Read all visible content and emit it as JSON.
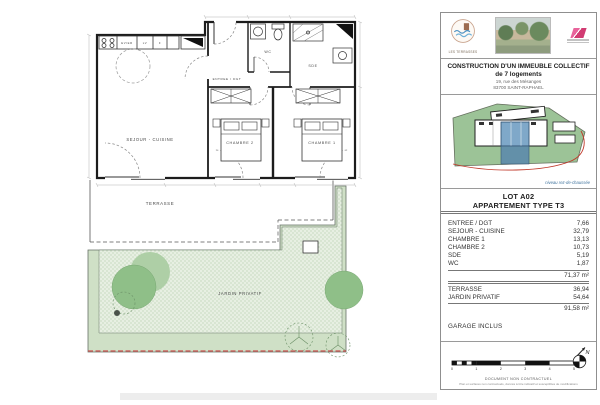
{
  "brand": {
    "name": "LES TERRASSES"
  },
  "project": {
    "title_line1": "CONSTRUCTION D'UN IMMEUBLE COLLECTIF",
    "title_line2": "de 7 logements",
    "address_line1": "19, rue des Mésanges",
    "address_line2": "83700 SAINT-RAPHAEL"
  },
  "siteplan": {
    "caption": "niveau rez-de-chaussée"
  },
  "lot": {
    "name": "LOT A02",
    "type": "APPARTEMENT TYPE T3"
  },
  "areas": {
    "rooms": [
      {
        "label": "ENTREE / DGT",
        "value": "7,66"
      },
      {
        "label": "SEJOUR - CUISINE",
        "value": "32,79"
      },
      {
        "label": "CHAMBRE 1",
        "value": "13,13"
      },
      {
        "label": "CHAMBRE 2",
        "value": "10,73"
      },
      {
        "label": "SDE",
        "value": "5,19"
      },
      {
        "label": "WC",
        "value": "1,87"
      }
    ],
    "interior_total": "71,37 m²",
    "outdoor": [
      {
        "label": "TERRASSE",
        "value": "36,94"
      },
      {
        "label": "JARDIN PRIVATIF",
        "value": "54,64"
      }
    ],
    "grand_total": "91,58 m²",
    "note": "GARAGE INCLUS"
  },
  "footer": {
    "scale_ticks": [
      "0",
      "1",
      "2",
      "3",
      "4",
      "5"
    ],
    "caption": "DOCUMENT NON CONTRACTUEL",
    "fine_print": "Plan et surfaces non contractuels, donnés à titre indicatif et susceptibles de modifications",
    "north_label": "N"
  },
  "plan": {
    "labels": {
      "sejour": "SEJOUR - CUISINE",
      "entree": "ENTREE / DGT",
      "wc": "WC",
      "sde": "SDE",
      "chambre2": "CHAMBRE 2",
      "chambre1": "CHAMBRE 1",
      "terrasse": "TERRASSE",
      "jardin": "JARDIN PRIVATIF"
    },
    "kitchen": {
      "sink": "EVIER",
      "dishwasher": "LV",
      "fridge": "F"
    }
  },
  "colors": {
    "site_green": "#9cc397",
    "unit_blue": "#7fa8c9",
    "garden_green": "#e7efe2",
    "tree_green": "#8fbf88",
    "boundary_red": "#c94f4f"
  }
}
